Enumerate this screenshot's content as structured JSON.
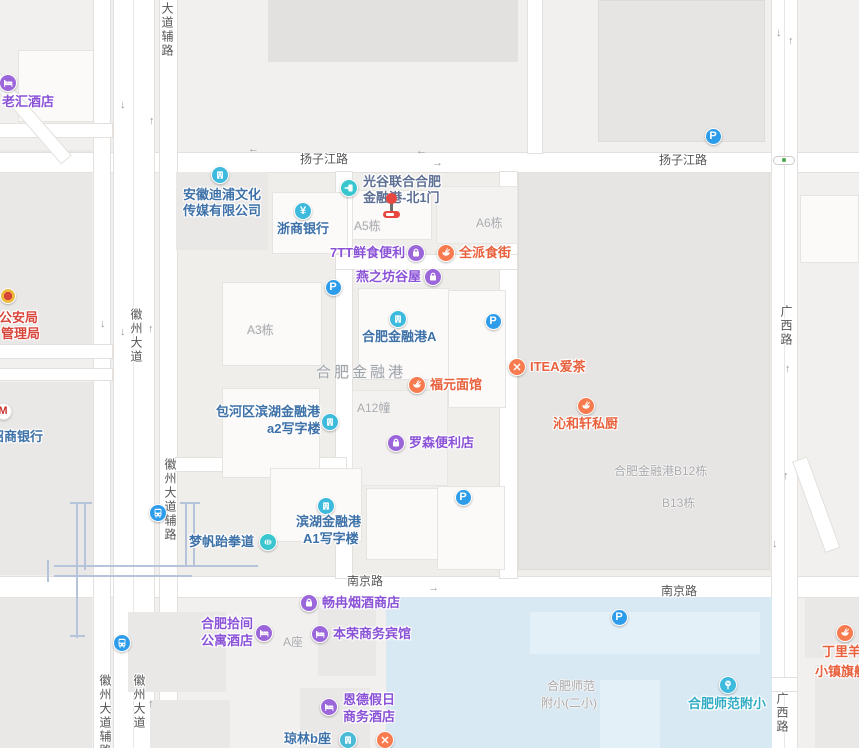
{
  "colors": {
    "purple_icon": "#9B66D9",
    "purple_text": "#8A52D6",
    "orange_icon": "#F87B50",
    "orange_text": "#E8603C",
    "cyan_icon": "#3EBADC",
    "blue_text": "#3D71A8",
    "teal_icon": "#3AC6CE",
    "gate_text": "#5E6F94",
    "school_text": "#2FABC4",
    "transit_icon": "#2D9CEA",
    "red_text": "#D9473C",
    "parking_icon": "#2D9CEA",
    "water": "#D8E9F4",
    "road_label": "#565656",
    "building_label": "#A8ABB0",
    "marker_red": "#E8473F"
  },
  "road_labels": [
    {
      "t": "扬子江路",
      "x": 300,
      "y": 152,
      "v": false
    },
    {
      "t": "扬子江路",
      "x": 659,
      "y": 153,
      "v": false
    },
    {
      "t": "南京路",
      "x": 347,
      "y": 574,
      "v": false
    },
    {
      "t": "南京路",
      "x": 661,
      "y": 584,
      "v": false
    },
    {
      "t": "大道辅路",
      "x": 160,
      "y": 2,
      "v": true
    },
    {
      "t": "徽州大道",
      "x": 129,
      "y": 308,
      "v": true
    },
    {
      "t": "徽州大道辅路",
      "x": 163,
      "y": 458,
      "v": true
    },
    {
      "t": "徽州大道",
      "x": 132,
      "y": 674,
      "v": true
    },
    {
      "t": "徽州大道辅路",
      "x": 98,
      "y": 674,
      "v": true
    },
    {
      "t": "广西路",
      "x": 779,
      "y": 305,
      "v": true
    },
    {
      "t": "广西路",
      "x": 775,
      "y": 692,
      "v": true
    }
  ],
  "area_labels": [
    {
      "t": "合肥金融港",
      "x": 316,
      "y": 366,
      "big": true
    },
    {
      "t": "合肥金融港B12栋",
      "x": 614,
      "y": 464,
      "big": false
    },
    {
      "t": "B13栋",
      "x": 662,
      "y": 496,
      "big": false
    },
    {
      "t": "A5栋",
      "x": 354,
      "y": 219,
      "big": false
    },
    {
      "t": "A6栋",
      "x": 476,
      "y": 216,
      "big": false
    },
    {
      "t": "A3栋",
      "x": 247,
      "y": 323,
      "big": false
    },
    {
      "t": "A12幢",
      "x": 357,
      "y": 401,
      "big": false
    },
    {
      "t": "A座",
      "x": 283,
      "y": 635,
      "big": false
    },
    {
      "t": "合肥师范",
      "x": 547,
      "y": 679,
      "big": false
    },
    {
      "t": "附小(二小)",
      "x": 541,
      "y": 696,
      "big": false
    }
  ],
  "pois": [
    {
      "id": "laohui-hotel",
      "cat": "hotel",
      "icon": {
        "type": "bed",
        "x": 8,
        "y": 83
      },
      "lines": [
        {
          "t": "老汇酒店",
          "x": 2,
          "y": 102
        }
      ]
    },
    {
      "id": "anhui-dipu-media-company",
      "cat": "company",
      "icon": {
        "type": "building",
        "x": 220,
        "y": 175
      },
      "lines": [
        {
          "t": "安徽迪浦文化",
          "x": 183,
          "y": 195
        },
        {
          "t": "传媒有限公司",
          "x": 183,
          "y": 211
        }
      ]
    },
    {
      "id": "zheshang-bank",
      "cat": "bank",
      "icon": {
        "type": "yuan",
        "x": 303,
        "y": 211
      },
      "lines": [
        {
          "t": "浙商银行",
          "x": 277,
          "y": 229
        }
      ]
    },
    {
      "id": "guanggu-finance-port-north-gate1",
      "cat": "entrance",
      "icon": {
        "type": "entrance",
        "x": 349,
        "y": 188
      },
      "lines": [
        {
          "t": "光谷联合合肥",
          "x": 363,
          "y": 182
        },
        {
          "t": "金融港-北1门",
          "x": 363,
          "y": 198
        }
      ]
    },
    {
      "id": "7tt-fresh-food-store",
      "cat": "shopping",
      "icon": {
        "type": "bag",
        "x": 416,
        "y": 253
      },
      "lines": [
        {
          "t": "7TT鲜食便利",
          "x": 330,
          "y": 253
        }
      ]
    },
    {
      "id": "quanpai-food-street",
      "cat": "food",
      "icon": {
        "type": "bowl",
        "x": 446,
        "y": 253
      },
      "lines": [
        {
          "t": "全派食街",
          "x": 459,
          "y": 253
        }
      ]
    },
    {
      "id": "yanzhifang-guwu",
      "cat": "shopping",
      "icon": {
        "type": "bag",
        "x": 433,
        "y": 277
      },
      "lines": [
        {
          "t": "燕之坊谷屋",
          "x": 356,
          "y": 277
        }
      ]
    },
    {
      "id": "hefei-finance-port-a",
      "cat": "company",
      "icon": {
        "type": "building",
        "x": 398,
        "y": 319
      },
      "lines": [
        {
          "t": "合肥金融港A",
          "x": 362,
          "y": 337
        }
      ]
    },
    {
      "id": "fuyuan-noodle",
      "cat": "food",
      "icon": {
        "type": "bowl",
        "x": 417,
        "y": 385
      },
      "lines": [
        {
          "t": "福元面馆",
          "x": 430,
          "y": 385
        }
      ]
    },
    {
      "id": "itea-tea",
      "cat": "food",
      "icon": {
        "type": "utensils",
        "x": 517,
        "y": 367
      },
      "lines": [
        {
          "t": "ITEA爱茶",
          "x": 530,
          "y": 367
        }
      ]
    },
    {
      "id": "qinhexuan-kitchen",
      "cat": "food",
      "icon": {
        "type": "bowl",
        "x": 586,
        "y": 406
      },
      "lines": [
        {
          "t": "沁和轩私厨",
          "x": 553,
          "y": 424
        }
      ]
    },
    {
      "id": "baohequ-binhu-a2-office",
      "cat": "company",
      "icon": {
        "type": "building",
        "x": 330,
        "y": 422
      },
      "lines": [
        {
          "t": "包河区滨湖金融港",
          "x": 216,
          "y": 412
        },
        {
          "t": "a2写字楼",
          "x": 267,
          "y": 429
        }
      ]
    },
    {
      "id": "lawson-store",
      "cat": "shopping",
      "icon": {
        "type": "bag",
        "x": 396,
        "y": 443
      },
      "lines": [
        {
          "t": "罗森便利店",
          "x": 409,
          "y": 443
        }
      ]
    },
    {
      "id": "binhu-a1-office",
      "cat": "company",
      "icon": {
        "type": "building",
        "x": 326,
        "y": 506
      },
      "lines": [
        {
          "t": "滨湖金融港",
          "x": 296,
          "y": 522
        },
        {
          "t": "A1写字楼",
          "x": 303,
          "y": 539
        }
      ]
    },
    {
      "id": "mengfan-taekwondo",
      "cat": "sport",
      "icon": {
        "type": "fist",
        "x": 268,
        "y": 542
      },
      "lines": [
        {
          "t": "梦帆跆拳道",
          "x": 189,
          "y": 542
        }
      ]
    },
    {
      "id": "changran-tobacco-shop",
      "cat": "shopping",
      "icon": {
        "type": "bag",
        "x": 309,
        "y": 603
      },
      "lines": [
        {
          "t": "畅冉烟酒商店",
          "x": 322,
          "y": 603
        }
      ]
    },
    {
      "id": "hefei-shijian-apartment-hotel",
      "cat": "hotel",
      "icon": {
        "type": "bed",
        "x": 264,
        "y": 633
      },
      "lines": [
        {
          "t": "合肥拾间",
          "x": 201,
          "y": 624
        },
        {
          "t": "公寓酒店",
          "x": 201,
          "y": 641
        }
      ]
    },
    {
      "id": "benrong-business-hotel",
      "cat": "hotel",
      "icon": {
        "type": "bed",
        "x": 320,
        "y": 634
      },
      "lines": [
        {
          "t": "本荣商务宾馆",
          "x": 333,
          "y": 634
        }
      ]
    },
    {
      "id": "ende-holiday-hotel",
      "cat": "hotel",
      "icon": {
        "type": "bed",
        "x": 329,
        "y": 707
      },
      "lines": [
        {
          "t": "恩德假日",
          "x": 343,
          "y": 700
        },
        {
          "t": "商务酒店",
          "x": 343,
          "y": 717
        }
      ]
    },
    {
      "id": "qionglin-b-block",
      "cat": "building-blue",
      "icon": {
        "type": "building",
        "x": 348,
        "y": 740
      },
      "lines": [
        {
          "t": "琼林b座",
          "x": 284,
          "y": 739
        }
      ]
    },
    {
      "id": "restaurant-unlabeled",
      "cat": "food",
      "icon": {
        "type": "utensils",
        "x": 385,
        "y": 740
      },
      "lines": []
    },
    {
      "id": "hefei-shifan-fuxiao",
      "cat": "school",
      "icon": {
        "type": "tree",
        "x": 728,
        "y": 685
      },
      "lines": [
        {
          "t": "合肥师范附小",
          "x": 688,
          "y": 704
        }
      ]
    },
    {
      "id": "dingliyang-flagship",
      "cat": "food",
      "icon": {
        "type": "bowl",
        "x": 845,
        "y": 633
      },
      "lines": [
        {
          "t": "丁里羊",
          "x": 822,
          "y": 652
        },
        {
          "t": "小镇旗舰店",
          "x": 815,
          "y": 672
        }
      ]
    },
    {
      "id": "public-security-bureau",
      "cat": "police",
      "icon": {
        "type": "emblem",
        "x": 8,
        "y": 296
      },
      "lines": [
        {
          "t": "市公安局",
          "x": -14,
          "y": 318
        },
        {
          "t": "管理局",
          "x": 1,
          "y": 334
        }
      ]
    },
    {
      "id": "cmb-bank",
      "cat": "cmb",
      "icon": {
        "type": "cmb",
        "x": 3,
        "y": 411
      },
      "lines": [
        {
          "t": "招商银行",
          "x": -9,
          "y": 437
        }
      ]
    },
    {
      "id": "metro-stop",
      "cat": "transit",
      "icon": {
        "type": "bus",
        "x": 158,
        "y": 513
      },
      "lines": []
    },
    {
      "id": "bus-stop",
      "cat": "transit",
      "icon": {
        "type": "bus",
        "x": 122,
        "y": 643
      },
      "lines": []
    }
  ],
  "parking": {
    "label": "P",
    "positions": [
      [
        713,
        136
      ],
      [
        333,
        287
      ],
      [
        493,
        321
      ],
      [
        463,
        497
      ],
      [
        619,
        617
      ]
    ]
  },
  "arrows": [
    {
      "d": "←",
      "x": 253,
      "y": 150
    },
    {
      "d": "←",
      "x": 421,
      "y": 152
    },
    {
      "d": "→",
      "x": 437,
      "y": 164
    },
    {
      "d": "→",
      "x": 433,
      "y": 589
    },
    {
      "d": "↓",
      "x": 125,
      "y": 106
    },
    {
      "d": "↑",
      "x": 154,
      "y": 122
    },
    {
      "d": "↓",
      "x": 105,
      "y": 325
    },
    {
      "d": "↓",
      "x": 125,
      "y": 333
    },
    {
      "d": "↑",
      "x": 153,
      "y": 330
    },
    {
      "d": "↑",
      "x": 153,
      "y": 705
    },
    {
      "d": "↓",
      "x": 781,
      "y": 34
    },
    {
      "d": "↑",
      "x": 793,
      "y": 42
    },
    {
      "d": "↑",
      "x": 790,
      "y": 370
    },
    {
      "d": "↑",
      "x": 788,
      "y": 477
    },
    {
      "d": "↓",
      "x": 777,
      "y": 545
    }
  ],
  "traffic_light": {
    "x": 784,
    "y": 160
  },
  "marker": {
    "x": 391,
    "y": 198
  }
}
